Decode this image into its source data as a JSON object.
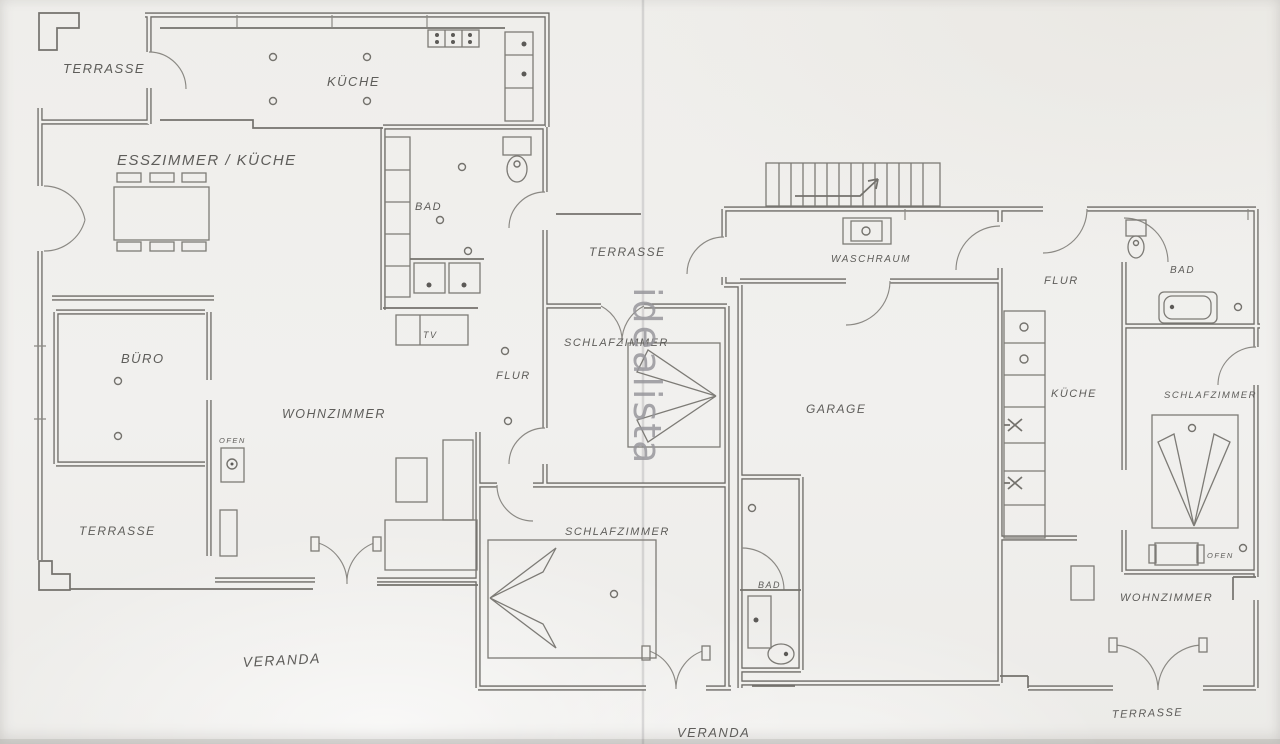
{
  "document_type": "scanned floor plan",
  "language": "German",
  "watermark": {
    "text": "idealista"
  },
  "colors": {
    "paper": "#f1f0ed",
    "ink": "#6c6a66",
    "label_ink": "#5e5d5a",
    "watermark_gray": "#98979c"
  },
  "labels": {
    "terrasse_nw": "TERRASSE",
    "kueche_main": "KÜCHE",
    "esszimmer_kueche": "ESSZIMMER / KÜCHE",
    "bad_main": "BAD",
    "tv": "TV",
    "flur_main": "FLUR",
    "buero": "BÜRO",
    "wohnzimmer_main": "WOHNZIMMER",
    "ofen_main": "OFEN",
    "terrasse_sw": "TERRASSE",
    "veranda_main": "VERANDA",
    "terrasse_center": "TERRASSE",
    "schlafzimmer_center": "SCHLAFZIMMER",
    "schlafzimmer_south": "SCHLAFZIMMER",
    "bad_south": "BAD",
    "veranda_south": "VERANDA",
    "waschraum": "WASCHRAUM",
    "garage": "GARAGE",
    "flur_annex": "FLUR",
    "bad_annex": "BAD",
    "kueche_annex": "KÜCHE",
    "schlafzimmer_annex": "SCHLAFZIMMER",
    "ofen_annex": "OFEN",
    "wohnzimmer_annex": "WOHNZIMMER",
    "terrasse_se": "TERRASSE"
  }
}
